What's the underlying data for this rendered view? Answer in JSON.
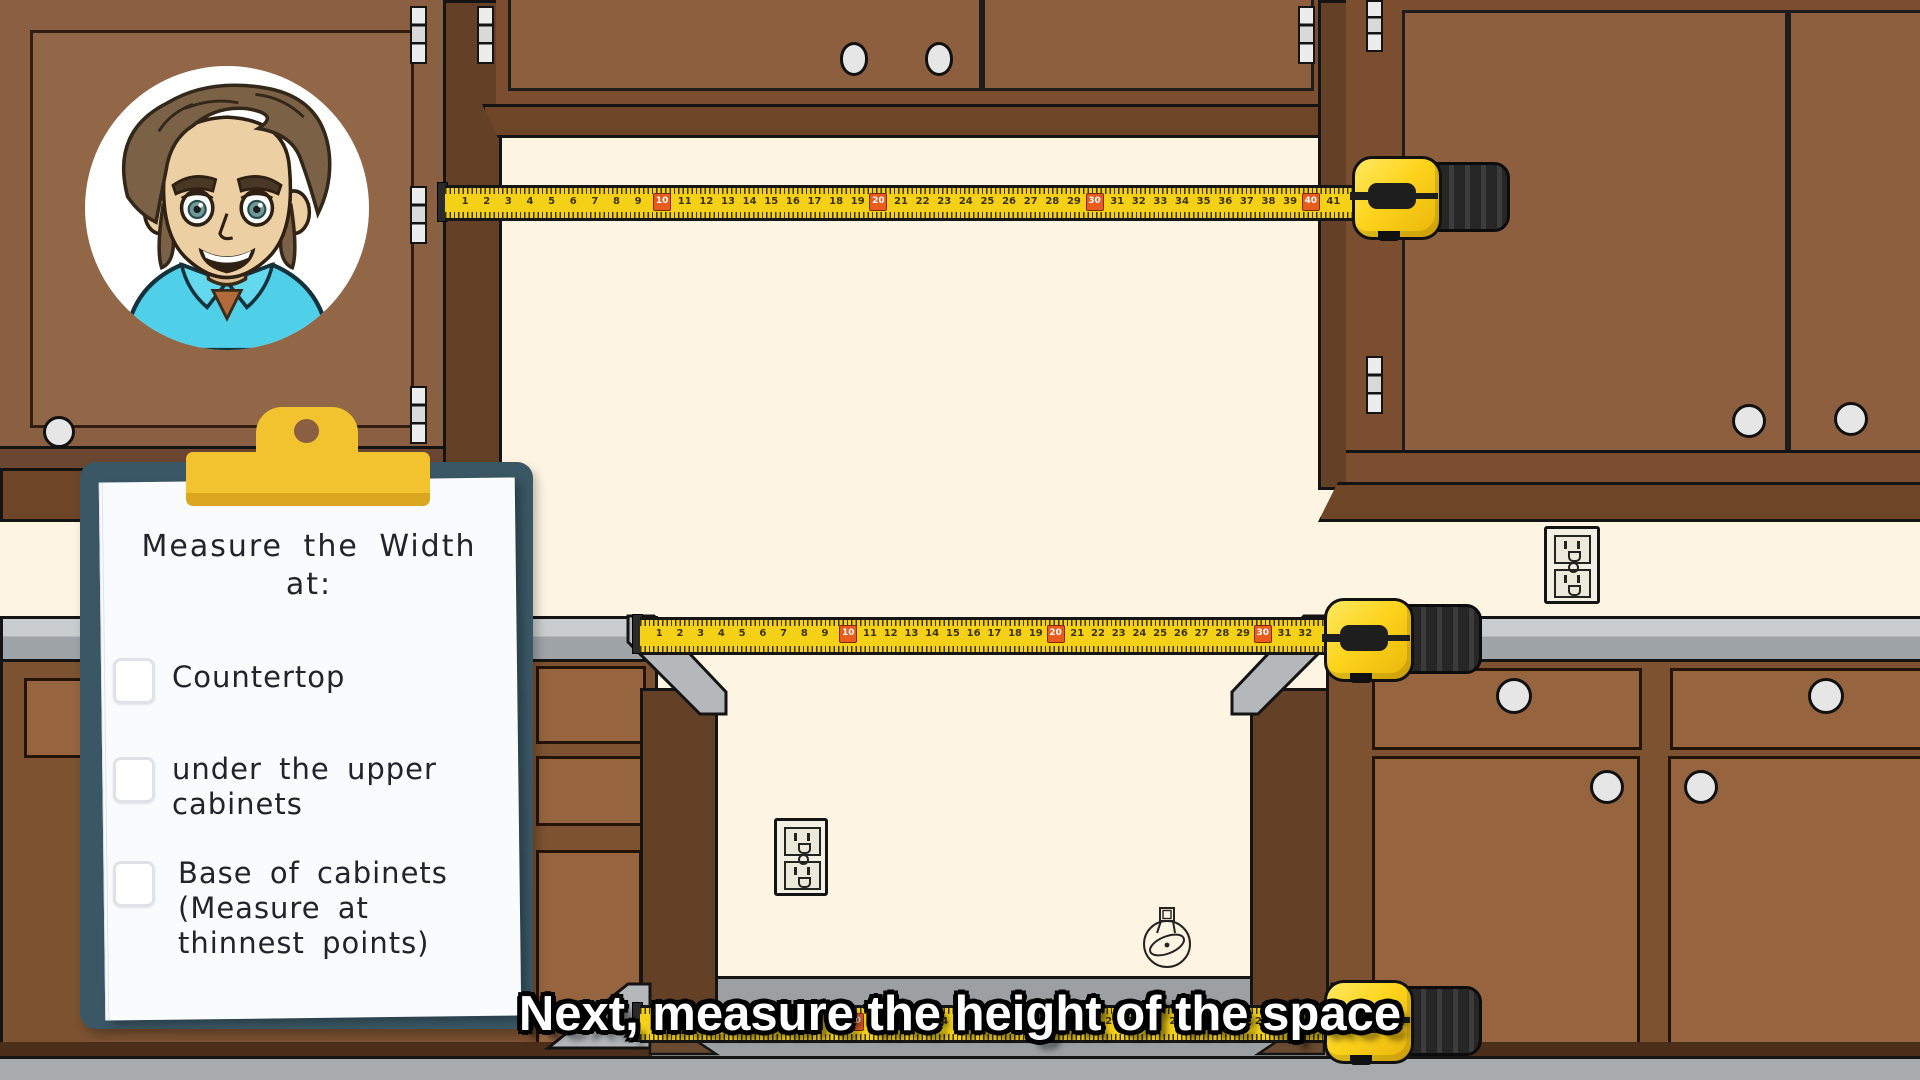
{
  "scene": {
    "description": "Cartoon kitchen tutorial frame: tape measures spanning an appliance alcove between cabinets",
    "presenter": "cartoon-man-avatar"
  },
  "caption": {
    "text": "Next, measure the height of the space"
  },
  "clipboard": {
    "heading": "Measure the Width\nat:",
    "items": [
      {
        "label": "Countertop",
        "checked": false
      },
      {
        "label": "under the upper\ncabinets",
        "checked": false
      },
      {
        "label": "Base of cabinets\n(Measure at\nthinnest points)",
        "checked": false
      }
    ]
  },
  "tapes": {
    "top": {
      "start": 1,
      "end": 41,
      "highlight_every": 10
    },
    "middle": {
      "start": 1,
      "end": 32,
      "highlight_every": 10
    },
    "bottom": {
      "start": 1,
      "end": 31,
      "highlight_every": 10
    }
  },
  "colors": {
    "wall": "#fdf4e2",
    "cabinet": "#8a5f42",
    "cabinet-dark": "#7a4e2e",
    "cabinet-panel": "#96653f",
    "molding": "#6f4527",
    "countertop": "#c9ccce",
    "countertop-shade": "#9fa4a8",
    "floor": "#a8abad",
    "alcove-floor": "#9da0a2",
    "tape-yellow": "#f4d116",
    "tape-highlight": "#e85c1d",
    "board": "#3a5765",
    "clip": "#f3c32f",
    "clip-shade": "#daa61e",
    "paper": "#fafbfd",
    "ink": "#23232b",
    "knob": "#e6e6e6",
    "outlet": "#f2efe3",
    "caption": "#ffffff"
  }
}
